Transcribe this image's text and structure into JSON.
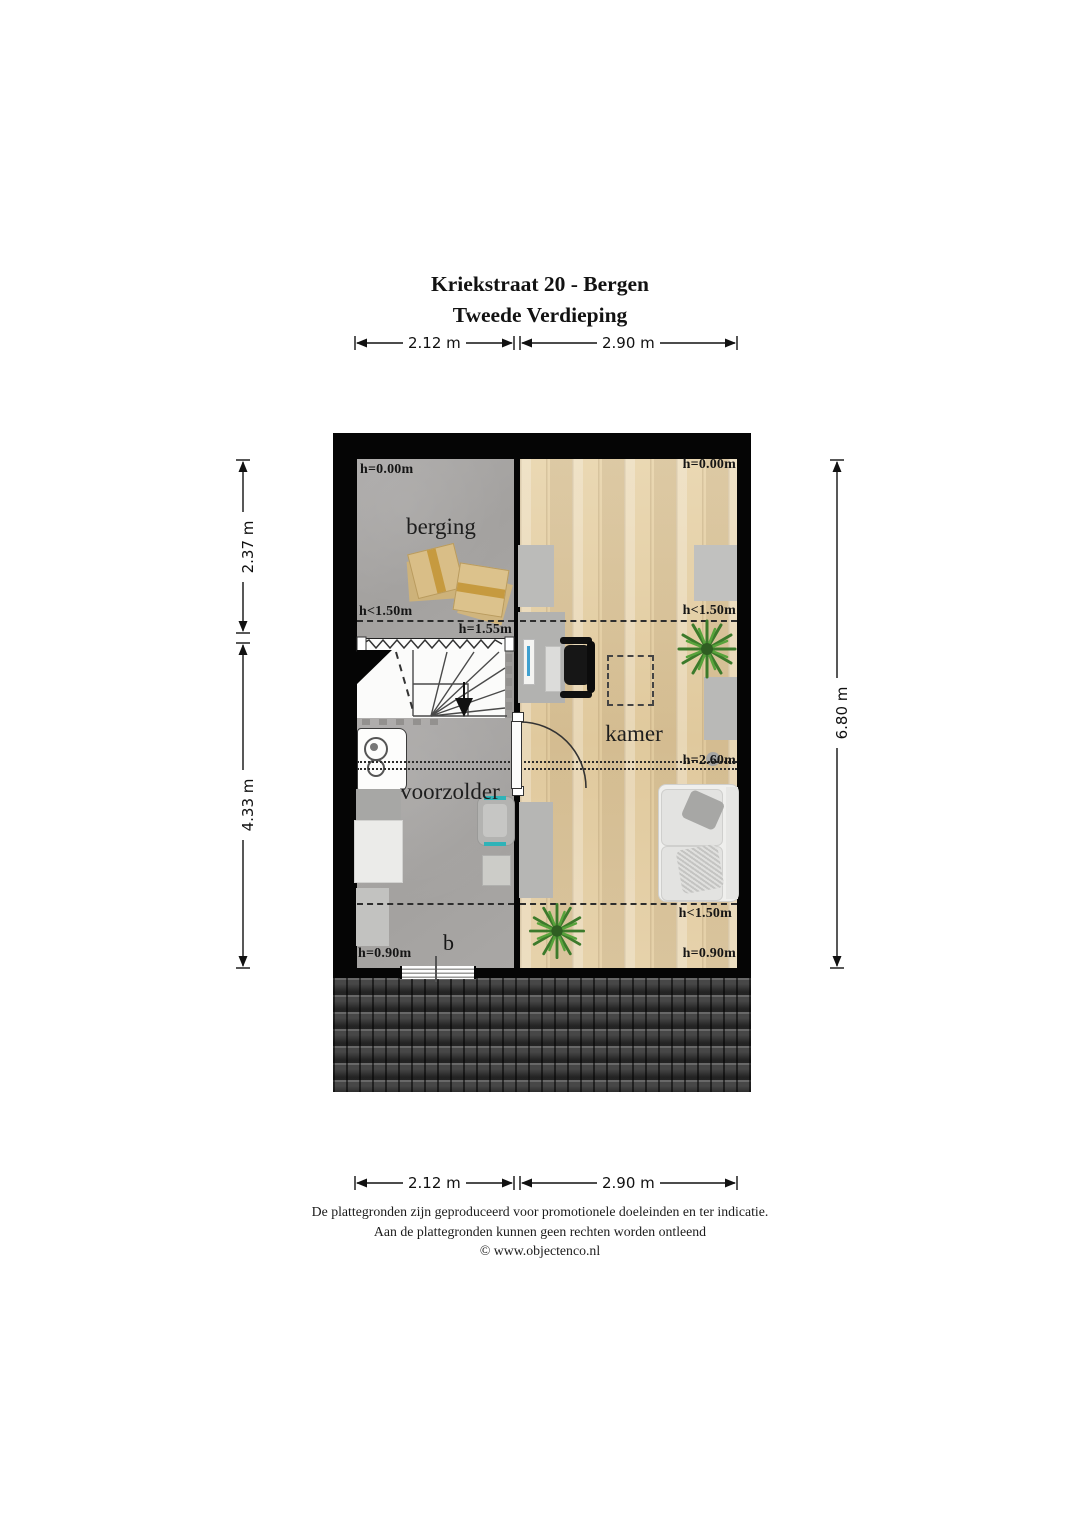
{
  "title": {
    "line1": "Kriekstraat 20 - Bergen",
    "line2": "Tweede Verdieping"
  },
  "dimensions": {
    "top_left": "2.12 m",
    "top_right": "2.90 m",
    "bottom_left": "2.12 m",
    "bottom_right": "2.90 m",
    "left_upper": "2.37 m",
    "left_lower": "4.33 m",
    "right_full": "6.80 m"
  },
  "rooms": {
    "berging": "berging",
    "voorzolder": "voorzolder",
    "kamer": "kamer"
  },
  "height_labels": {
    "berging_top": "h=0.00m",
    "kamer_top": "h=0.00m",
    "berging_knee": "h<1.50m",
    "stairs_head": "h=1.55m",
    "kamer_knee_top": "h<1.50m",
    "ridge": "h=2.60m",
    "kamer_knee_bottom": "h<1.50m",
    "voorzolder_bottom": "h=0.90m",
    "kamer_bottom": "h=0.90m"
  },
  "window_label": "b",
  "footer": {
    "line1": "De plattegronden zijn geproduceerd voor promotionele doeleinden en ter indicatie.",
    "line2": "Aan de plattegronden kunnen geen rechten worden ontleend",
    "line3": "© www.objectenco.nl"
  },
  "colors": {
    "wall": "#050505",
    "floor_gray": "#a8a6a4",
    "floor_wood": "#e3cfa8",
    "roof": "#474747",
    "accent_teal": "#2fb3b8",
    "plant_green": "#3c7a2b",
    "box_tan": "#d9be87"
  }
}
